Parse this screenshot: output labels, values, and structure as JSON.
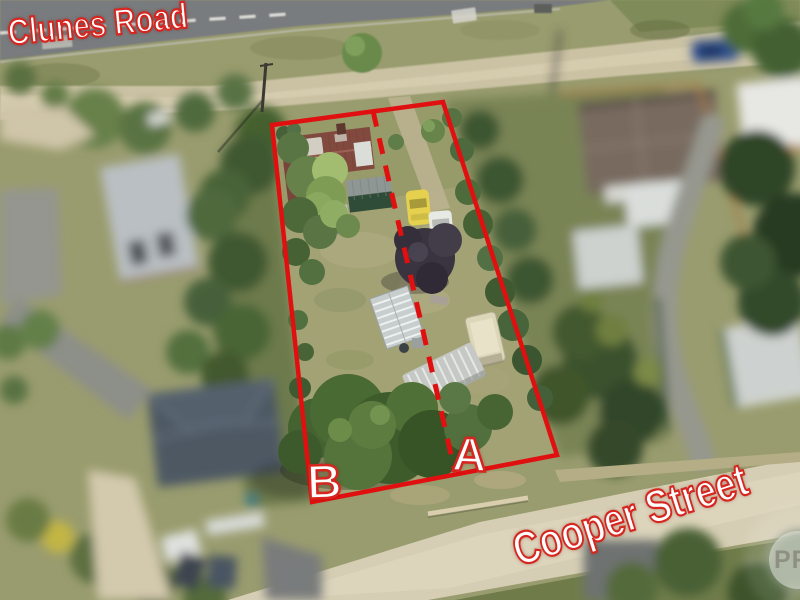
{
  "overlay": {
    "street_labels": [
      {
        "name": "Clunes Road"
      },
      {
        "name": "Cooper Street"
      }
    ],
    "lot_labels": [
      {
        "label": "A"
      },
      {
        "label": "B"
      }
    ],
    "watermark": {
      "text": "PR"
    },
    "colors": {
      "boundary-red": "#e01010",
      "label-text": "#ffffff",
      "label-outline": "#d6261f",
      "watermark-text": "#8e9083"
    }
  }
}
